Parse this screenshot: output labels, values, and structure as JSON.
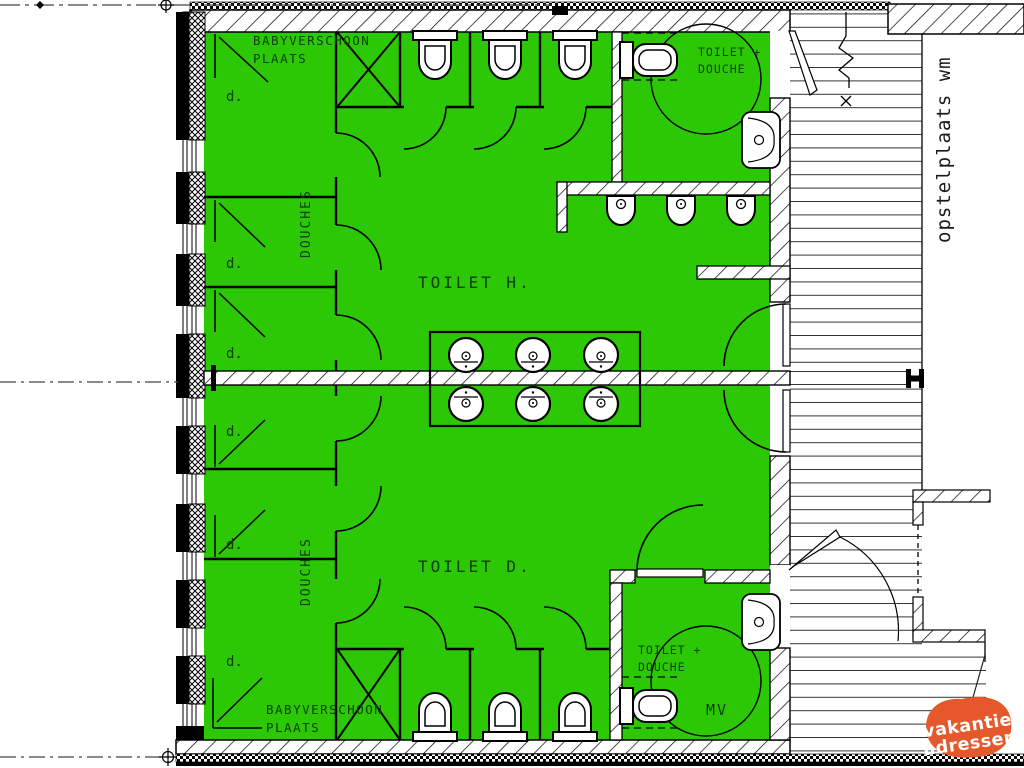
{
  "drawing": {
    "type": "sanitary-building-floor-plan",
    "colors": {
      "room_fill": "#2cc806",
      "line": "#000000",
      "label": "#0a4000",
      "deck_line": "#333333",
      "logo_orange": "#e4582b",
      "logo_text": "#ffffff"
    },
    "labels": {
      "babyverschoon1": "BABYVERSCHOON",
      "babyverschoon2": "PLAATS",
      "douches": "DOUCHES",
      "toilet_h": "TOILET  H.",
      "toilet_d": "TOILET  D.",
      "toilet_douche1": "TOILET +",
      "toilet_douche2": "DOUCHE",
      "shower": "d.",
      "mv": "MV",
      "opstelplaats": "opstelplaats wm"
    },
    "logo": {
      "line1": "vakantie",
      "line2": "adressen"
    },
    "fixtures": {
      "stall_toilets": 6,
      "accessible_toilets": 2,
      "urinals": 3,
      "washbasins": 6,
      "wall_sinks": 2,
      "wheelchair_turning_circles": 2,
      "baby_changing_tables": 2,
      "shower_stall_labels": 6
    }
  }
}
